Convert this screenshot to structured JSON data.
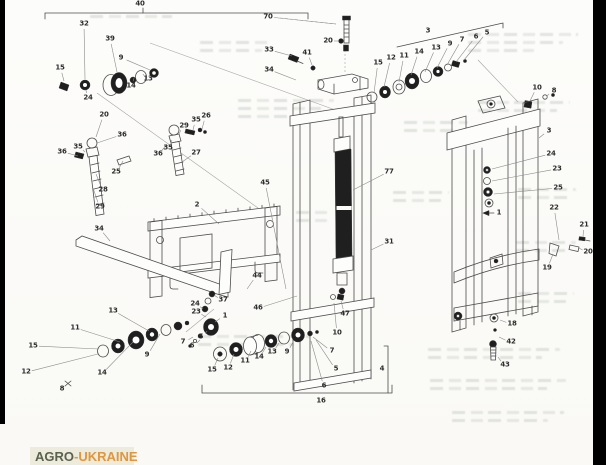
{
  "page": {
    "background": "#fbfbf8"
  },
  "scan_artifacts": {
    "left_bar_color": "#000000",
    "right_bar_color": "#000000"
  },
  "watermark_logo": {
    "text_primary": "AGRO",
    "text_secondary": "-UKRAINE",
    "bg_color": "#ecebdc",
    "primary_color": "#5b614f",
    "secondary_color": "#e0953f"
  },
  "diagram": {
    "labels": [
      {
        "t": "40",
        "x": 140,
        "y": 4
      },
      {
        "t": "70",
        "x": 268,
        "y": 17,
        "lx": 336,
        "ly": 24
      },
      {
        "t": "32",
        "x": 84,
        "y": 24,
        "lx": 85,
        "ly": 79
      },
      {
        "t": "39",
        "x": 110,
        "y": 39,
        "lx": 117,
        "ly": 72
      },
      {
        "t": "9",
        "x": 121,
        "y": 58,
        "lx": 150,
        "ly": 70
      },
      {
        "t": "13",
        "x": 148,
        "y": 79,
        "lx": 143,
        "ly": 74
      },
      {
        "t": "14",
        "x": 131,
        "y": 86,
        "lx": 134,
        "ly": 78
      },
      {
        "t": "15",
        "x": 60,
        "y": 68,
        "lx": 64,
        "ly": 81
      },
      {
        "t": "24",
        "x": 88,
        "y": 98,
        "lx": 86,
        "ly": 90
      },
      {
        "t": "20",
        "x": 104,
        "y": 115,
        "lx": 96,
        "ly": 137
      },
      {
        "t": "36",
        "x": 122,
        "y": 135,
        "lx": 97,
        "ly": 143
      },
      {
        "t": "35",
        "x": 78,
        "y": 147,
        "lx": 85,
        "ly": 152
      },
      {
        "t": "36",
        "x": 62,
        "y": 152,
        "lx": 78,
        "ly": 156
      },
      {
        "t": "25",
        "x": 116,
        "y": 172,
        "lx": 123,
        "ly": 161
      },
      {
        "t": "28",
        "x": 103,
        "y": 190,
        "lx": 96,
        "ly": 174
      },
      {
        "t": "29",
        "x": 100,
        "y": 207,
        "lx": 93,
        "ly": 188
      },
      {
        "t": "34",
        "x": 99,
        "y": 229,
        "lx": 110,
        "ly": 241
      },
      {
        "t": "26",
        "x": 206,
        "y": 116,
        "lx": 202,
        "ly": 129
      },
      {
        "t": "35",
        "x": 196,
        "y": 120,
        "lx": 193,
        "ly": 130
      },
      {
        "t": "29",
        "x": 184,
        "y": 126,
        "lx": 179,
        "ly": 134
      },
      {
        "t": "35",
        "x": 168,
        "y": 148,
        "lx": 172,
        "ly": 140
      },
      {
        "t": "36",
        "x": 158,
        "y": 154,
        "lx": 167,
        "ly": 144
      },
      {
        "t": "27",
        "x": 196,
        "y": 153,
        "lx": 182,
        "ly": 162
      },
      {
        "t": "33",
        "x": 269,
        "y": 50,
        "lx": 292,
        "ly": 56
      },
      {
        "t": "41",
        "x": 307,
        "y": 53,
        "lx": 312,
        "ly": 65
      },
      {
        "t": "34",
        "x": 269,
        "y": 70,
        "lx": 296,
        "ly": 80
      },
      {
        "t": "20",
        "x": 328,
        "y": 41,
        "lx": 338,
        "ly": 41
      },
      {
        "t": "15",
        "x": 378,
        "y": 63,
        "lx": 374,
        "ly": 93
      },
      {
        "t": "12",
        "x": 391,
        "y": 58,
        "lx": 384,
        "ly": 87
      },
      {
        "t": "11",
        "x": 404,
        "y": 56,
        "lx": 399,
        "ly": 82
      },
      {
        "t": "14",
        "x": 419,
        "y": 52,
        "lx": 411,
        "ly": 75
      },
      {
        "t": "13",
        "x": 436,
        "y": 48,
        "lx": 425,
        "ly": 72
      },
      {
        "t": "9",
        "x": 450,
        "y": 44,
        "lx": 437,
        "ly": 68
      },
      {
        "t": "7",
        "x": 462,
        "y": 40,
        "lx": 447,
        "ly": 65
      },
      {
        "t": "6",
        "x": 476,
        "y": 37,
        "lx": 456,
        "ly": 62
      },
      {
        "t": "5",
        "x": 487,
        "y": 33,
        "lx": 464,
        "ly": 60
      },
      {
        "t": "3",
        "x": 428,
        "y": 31
      },
      {
        "t": "10",
        "x": 537,
        "y": 88,
        "lx": 530,
        "ly": 101
      },
      {
        "t": "8",
        "x": 554,
        "y": 91,
        "lx": 547,
        "ly": 96
      },
      {
        "t": "3",
        "x": 549,
        "y": 131,
        "lx": 539,
        "ly": 138
      },
      {
        "t": "24",
        "x": 551,
        "y": 154,
        "lx": 492,
        "ly": 169
      },
      {
        "t": "23",
        "x": 557,
        "y": 169,
        "lx": 492,
        "ly": 181
      },
      {
        "t": "25",
        "x": 558,
        "y": 188,
        "lx": 494,
        "ly": 194
      },
      {
        "t": "1",
        "x": 499,
        "y": 213
      },
      {
        "t": "22",
        "x": 554,
        "y": 208,
        "lx": 559,
        "ly": 240
      },
      {
        "t": "21",
        "x": 584,
        "y": 225,
        "lx": 583,
        "ly": 237
      },
      {
        "t": "20",
        "x": 588,
        "y": 252,
        "lx": 579,
        "ly": 248
      },
      {
        "t": "19",
        "x": 547,
        "y": 268,
        "lx": 553,
        "ly": 254
      },
      {
        "t": "77",
        "x": 389,
        "y": 172,
        "lx": 353,
        "ly": 190
      },
      {
        "t": "31",
        "x": 389,
        "y": 242,
        "lx": 371,
        "ly": 250
      },
      {
        "t": "2",
        "x": 197,
        "y": 205,
        "lx": 219,
        "ly": 224
      },
      {
        "t": "45",
        "x": 265,
        "y": 183,
        "lx": 286,
        "ly": 289
      },
      {
        "t": "44",
        "x": 257,
        "y": 276,
        "lx": 247,
        "ly": 289
      },
      {
        "t": "46",
        "x": 258,
        "y": 308,
        "lx": 297,
        "ly": 296
      },
      {
        "t": "47",
        "x": 345,
        "y": 314,
        "lx": 341,
        "ly": 301
      },
      {
        "t": "10",
        "x": 337,
        "y": 333,
        "lx": 334,
        "ly": 303
      },
      {
        "t": "37",
        "x": 223,
        "y": 300,
        "lx": 214,
        "ly": 295
      },
      {
        "t": "24",
        "x": 195,
        "y": 304,
        "lx": 203,
        "ly": 309
      },
      {
        "t": "23",
        "x": 196,
        "y": 312,
        "lx": 206,
        "ly": 317
      },
      {
        "t": "1",
        "x": 225,
        "y": 316,
        "lx": 215,
        "ly": 322
      },
      {
        "t": "5",
        "x": 201,
        "y": 337,
        "lx": 207,
        "ly": 331
      },
      {
        "t": "6",
        "x": 192,
        "y": 346,
        "lx": 200,
        "ly": 340
      },
      {
        "t": "7",
        "x": 183,
        "y": 342,
        "lx": 193,
        "ly": 337
      },
      {
        "t": "13",
        "x": 113,
        "y": 311,
        "lx": 149,
        "ly": 331
      },
      {
        "t": "11",
        "x": 75,
        "y": 328,
        "lx": 120,
        "ly": 342
      },
      {
        "t": "15",
        "x": 33,
        "y": 346,
        "lx": 99,
        "ly": 349
      },
      {
        "t": "12",
        "x": 26,
        "y": 372,
        "lx": 98,
        "ly": 354
      },
      {
        "t": "14",
        "x": 102,
        "y": 373,
        "lx": 133,
        "ly": 342
      },
      {
        "t": "9",
        "x": 147,
        "y": 355,
        "lx": 160,
        "ly": 334
      },
      {
        "t": "8",
        "x": 62,
        "y": 389
      },
      {
        "t": "15",
        "x": 212,
        "y": 370,
        "lx": 218,
        "ly": 358
      },
      {
        "t": "12",
        "x": 228,
        "y": 368,
        "lx": 234,
        "ly": 354
      },
      {
        "t": "11",
        "x": 245,
        "y": 361,
        "lx": 251,
        "ly": 351
      },
      {
        "t": "14",
        "x": 259,
        "y": 357,
        "lx": 266,
        "ly": 347
      },
      {
        "t": "13",
        "x": 272,
        "y": 352,
        "lx": 279,
        "ly": 343
      },
      {
        "t": "9",
        "x": 287,
        "y": 352,
        "lx": 294,
        "ly": 340
      },
      {
        "t": "7",
        "x": 332,
        "y": 351,
        "lx": 313,
        "ly": 337
      },
      {
        "t": "5",
        "x": 336,
        "y": 369,
        "lx": 316,
        "ly": 340
      },
      {
        "t": "6",
        "x": 324,
        "y": 386,
        "lx": 311,
        "ly": 341
      },
      {
        "t": "4",
        "x": 382,
        "y": 369
      },
      {
        "t": "16",
        "x": 321,
        "y": 401
      },
      {
        "t": "18",
        "x": 512,
        "y": 324,
        "lx": 500,
        "ly": 320
      },
      {
        "t": "42",
        "x": 511,
        "y": 342,
        "lx": 499,
        "ly": 337
      },
      {
        "t": "43",
        "x": 505,
        "y": 365,
        "lx": 498,
        "ly": 357
      }
    ]
  }
}
